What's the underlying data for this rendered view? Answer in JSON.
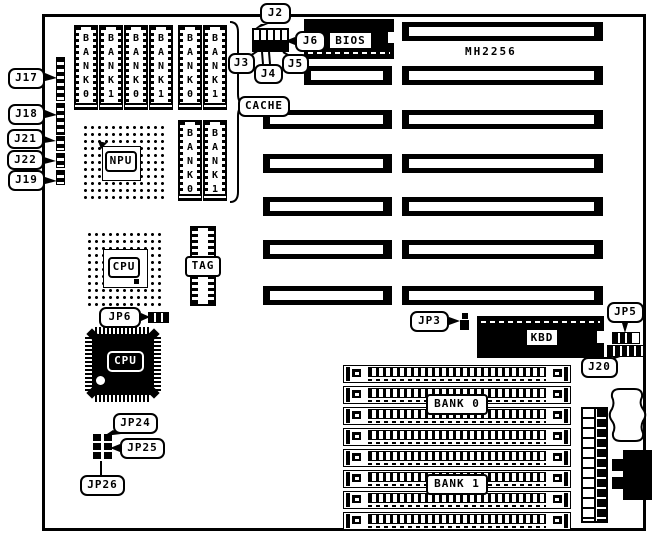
{
  "board": {
    "model": "MH2256"
  },
  "callouts": {
    "j2": "J2",
    "j3": "J3",
    "j4": "J4",
    "j5": "J5",
    "j6": "J6",
    "j17": "J17",
    "j18": "J18",
    "j21": "J21",
    "j22": "J22",
    "j19": "J19",
    "cache": "CACHE",
    "jp6": "JP6",
    "jp3": "JP3",
    "jp5": "JP5",
    "j20": "J20",
    "jp24": "JP24",
    "jp25": "JP25",
    "jp26": "JP26"
  },
  "chips": {
    "bios": "BIOS",
    "kbd": "KBD",
    "npu": "NPU",
    "cpu_socket": "CPU",
    "cpu_qfp": "CPU",
    "tag": "TAG"
  },
  "memory": {
    "vslots": [
      "BANK 0",
      "BANK 1",
      "BANK 0",
      "BANK 1",
      "BANK 0",
      "BANK 1"
    ],
    "cache_vslots": [
      "BANK 0",
      "BANK 1"
    ],
    "simm_banks": [
      "BANK 0",
      "BANK 1"
    ]
  }
}
